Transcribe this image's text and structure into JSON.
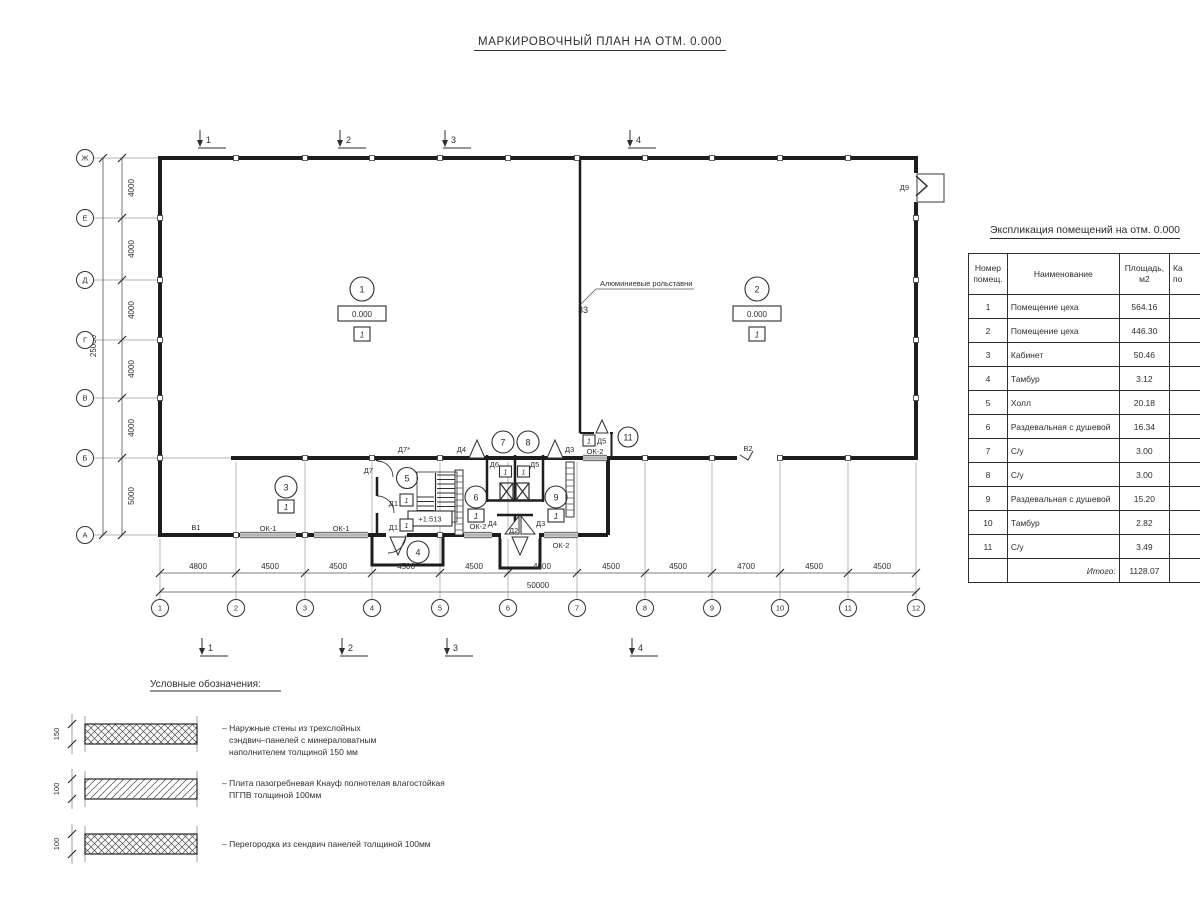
{
  "title": "МАРКИРОВОЧНЫЙ ПЛАН НА ОТМ. 0.000",
  "plan": {
    "section_marks": [
      "1",
      "2",
      "3",
      "4"
    ],
    "columns": [
      "1",
      "2",
      "3",
      "4",
      "5",
      "6",
      "7",
      "8",
      "9",
      "10",
      "11",
      "12"
    ],
    "rows": [
      "Ж",
      "Е",
      "Д",
      "Г",
      "В",
      "Б",
      "А"
    ],
    "bottom_dims": [
      "4800",
      "4500",
      "4500",
      "4500",
      "4500",
      "4500",
      "4500",
      "4500",
      "4700",
      "4500",
      "4500"
    ],
    "bottom_total": "50000",
    "left_dims": [
      "4000",
      "4000",
      "4000",
      "4000",
      "4000",
      "5000"
    ],
    "left_total": "25000",
    "level_mark": "0.000",
    "category_mark": "1",
    "stair_level": "+1.513",
    "rollshutter_label": "Алюминиевые рольставни",
    "rollshutter_mark": "33",
    "room_nums": {
      "r1": "1",
      "r2": "2",
      "r3": "3",
      "r4": "4",
      "r5": "5",
      "r6": "6",
      "r7": "7",
      "r8": "8",
      "r9": "9",
      "r11": "11"
    },
    "doors": {
      "d1": "Д1",
      "d2": "Д2",
      "d3": "Д3",
      "d4": "Д4",
      "d5": "Д5",
      "d6": "Д6",
      "d7": "Д7",
      "d7s": "Д7*",
      "d9": "Д9"
    },
    "gates": {
      "v1": "В1",
      "v2": "В2"
    },
    "windows": {
      "ok1": "ОК-1",
      "ok2": "ОК-2"
    }
  },
  "table": {
    "title": "Экспликация помещений на отм. 0.000",
    "headers": {
      "num_l1": "Номер",
      "num_l2": "помещ.",
      "name": "Наименование",
      "area_l1": "Площадь,",
      "area_l2": "м2",
      "cat_l1": "Ка",
      "cat_l2": "по"
    },
    "rows": [
      {
        "num": "1",
        "name": "Помещение цеха",
        "area": "564.16"
      },
      {
        "num": "2",
        "name": "Помещение цеха",
        "area": "446.30"
      },
      {
        "num": "3",
        "name": "Кабинет",
        "area": "50.46"
      },
      {
        "num": "4",
        "name": "Тамбур",
        "area": "3.12"
      },
      {
        "num": "5",
        "name": "Холл",
        "area": "20.18"
      },
      {
        "num": "6",
        "name": "Раздевальная с душевой",
        "area": "16.34"
      },
      {
        "num": "7",
        "name": "С/у",
        "area": "3.00"
      },
      {
        "num": "8",
        "name": "С/у",
        "area": "3.00"
      },
      {
        "num": "9",
        "name": "Раздевальная с душевой",
        "area": "15.20"
      },
      {
        "num": "10",
        "name": "Тамбур",
        "area": "2.82"
      },
      {
        "num": "11",
        "name": "С/у",
        "area": "3.49"
      }
    ],
    "total_label": "Итого:",
    "total_area": "1128.07"
  },
  "legend": {
    "heading": "Условные обозначения:",
    "items": [
      {
        "dim": "150",
        "lines": [
          "– Наружные стены из трехслойных",
          "сэндвич–панелей с минераловатным",
          "наполнителем толщиной 150 мм"
        ]
      },
      {
        "dim": "100",
        "lines": [
          "– Плита пазогребневая Кнауф полнотелая влагостойкая",
          "ПГПВ толщиной 100мм"
        ]
      },
      {
        "dim": "100",
        "lines": [
          "– Перегородка из сендвич панелей толщиной 100мм"
        ]
      }
    ]
  }
}
